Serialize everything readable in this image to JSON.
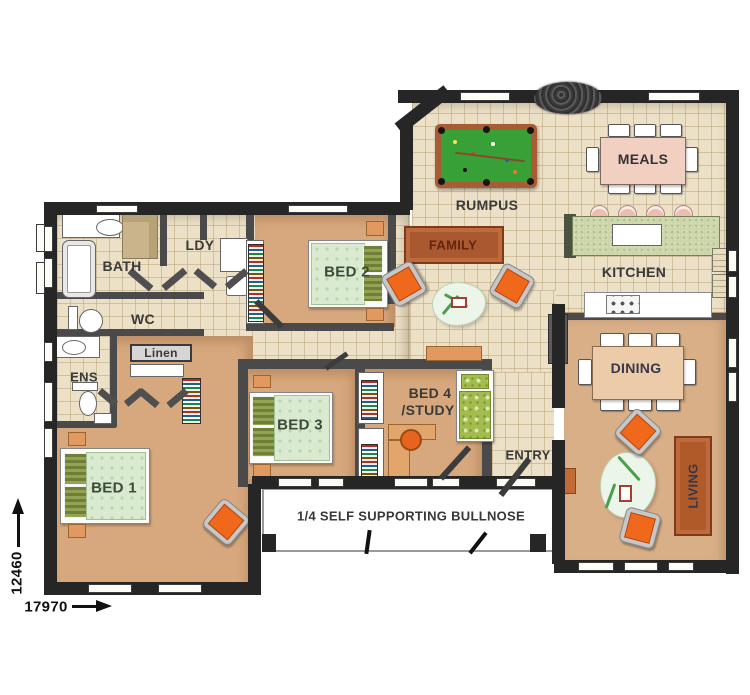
{
  "plan": {
    "note": "1/4 SELF SUPPORTING BULLNOSE",
    "dim_horizontal": "17970",
    "dim_vertical": "12460"
  },
  "rooms": {
    "bath": "BATH",
    "laundry": "LDY",
    "wc": "WC",
    "ensuite": "ENS",
    "linen": "Linen",
    "bed1": "BED 1",
    "bed2": "BED 2",
    "bed3": "BED 3",
    "bed4_line1": "BED 4",
    "bed4_line2": "/STUDY",
    "rumpus": "RUMPUS",
    "kitchen": "KITCHEN",
    "entry": "ENTRY"
  },
  "furniture": {
    "family_sofa": "FAMILY",
    "meals_table": "MEALS",
    "dining_table": "DINING",
    "living_sofa": "LIVING"
  },
  "colors": {
    "wall": "#262626",
    "tile_floor": "#ece1c7",
    "carpet": "#d7a87d",
    "pool_table_felt": "#37a037",
    "pool_table_rail": "#a85c35",
    "sofa_brown": "#a9582f",
    "armchair_orange": "#f0681c",
    "kitchen_island": "#ccd6aa",
    "meals_table_top": "#f1d0c1",
    "dining_table_top": "#eccba9",
    "bed_duvet": "#d9ead1",
    "label_text": "#3a3a3a"
  }
}
